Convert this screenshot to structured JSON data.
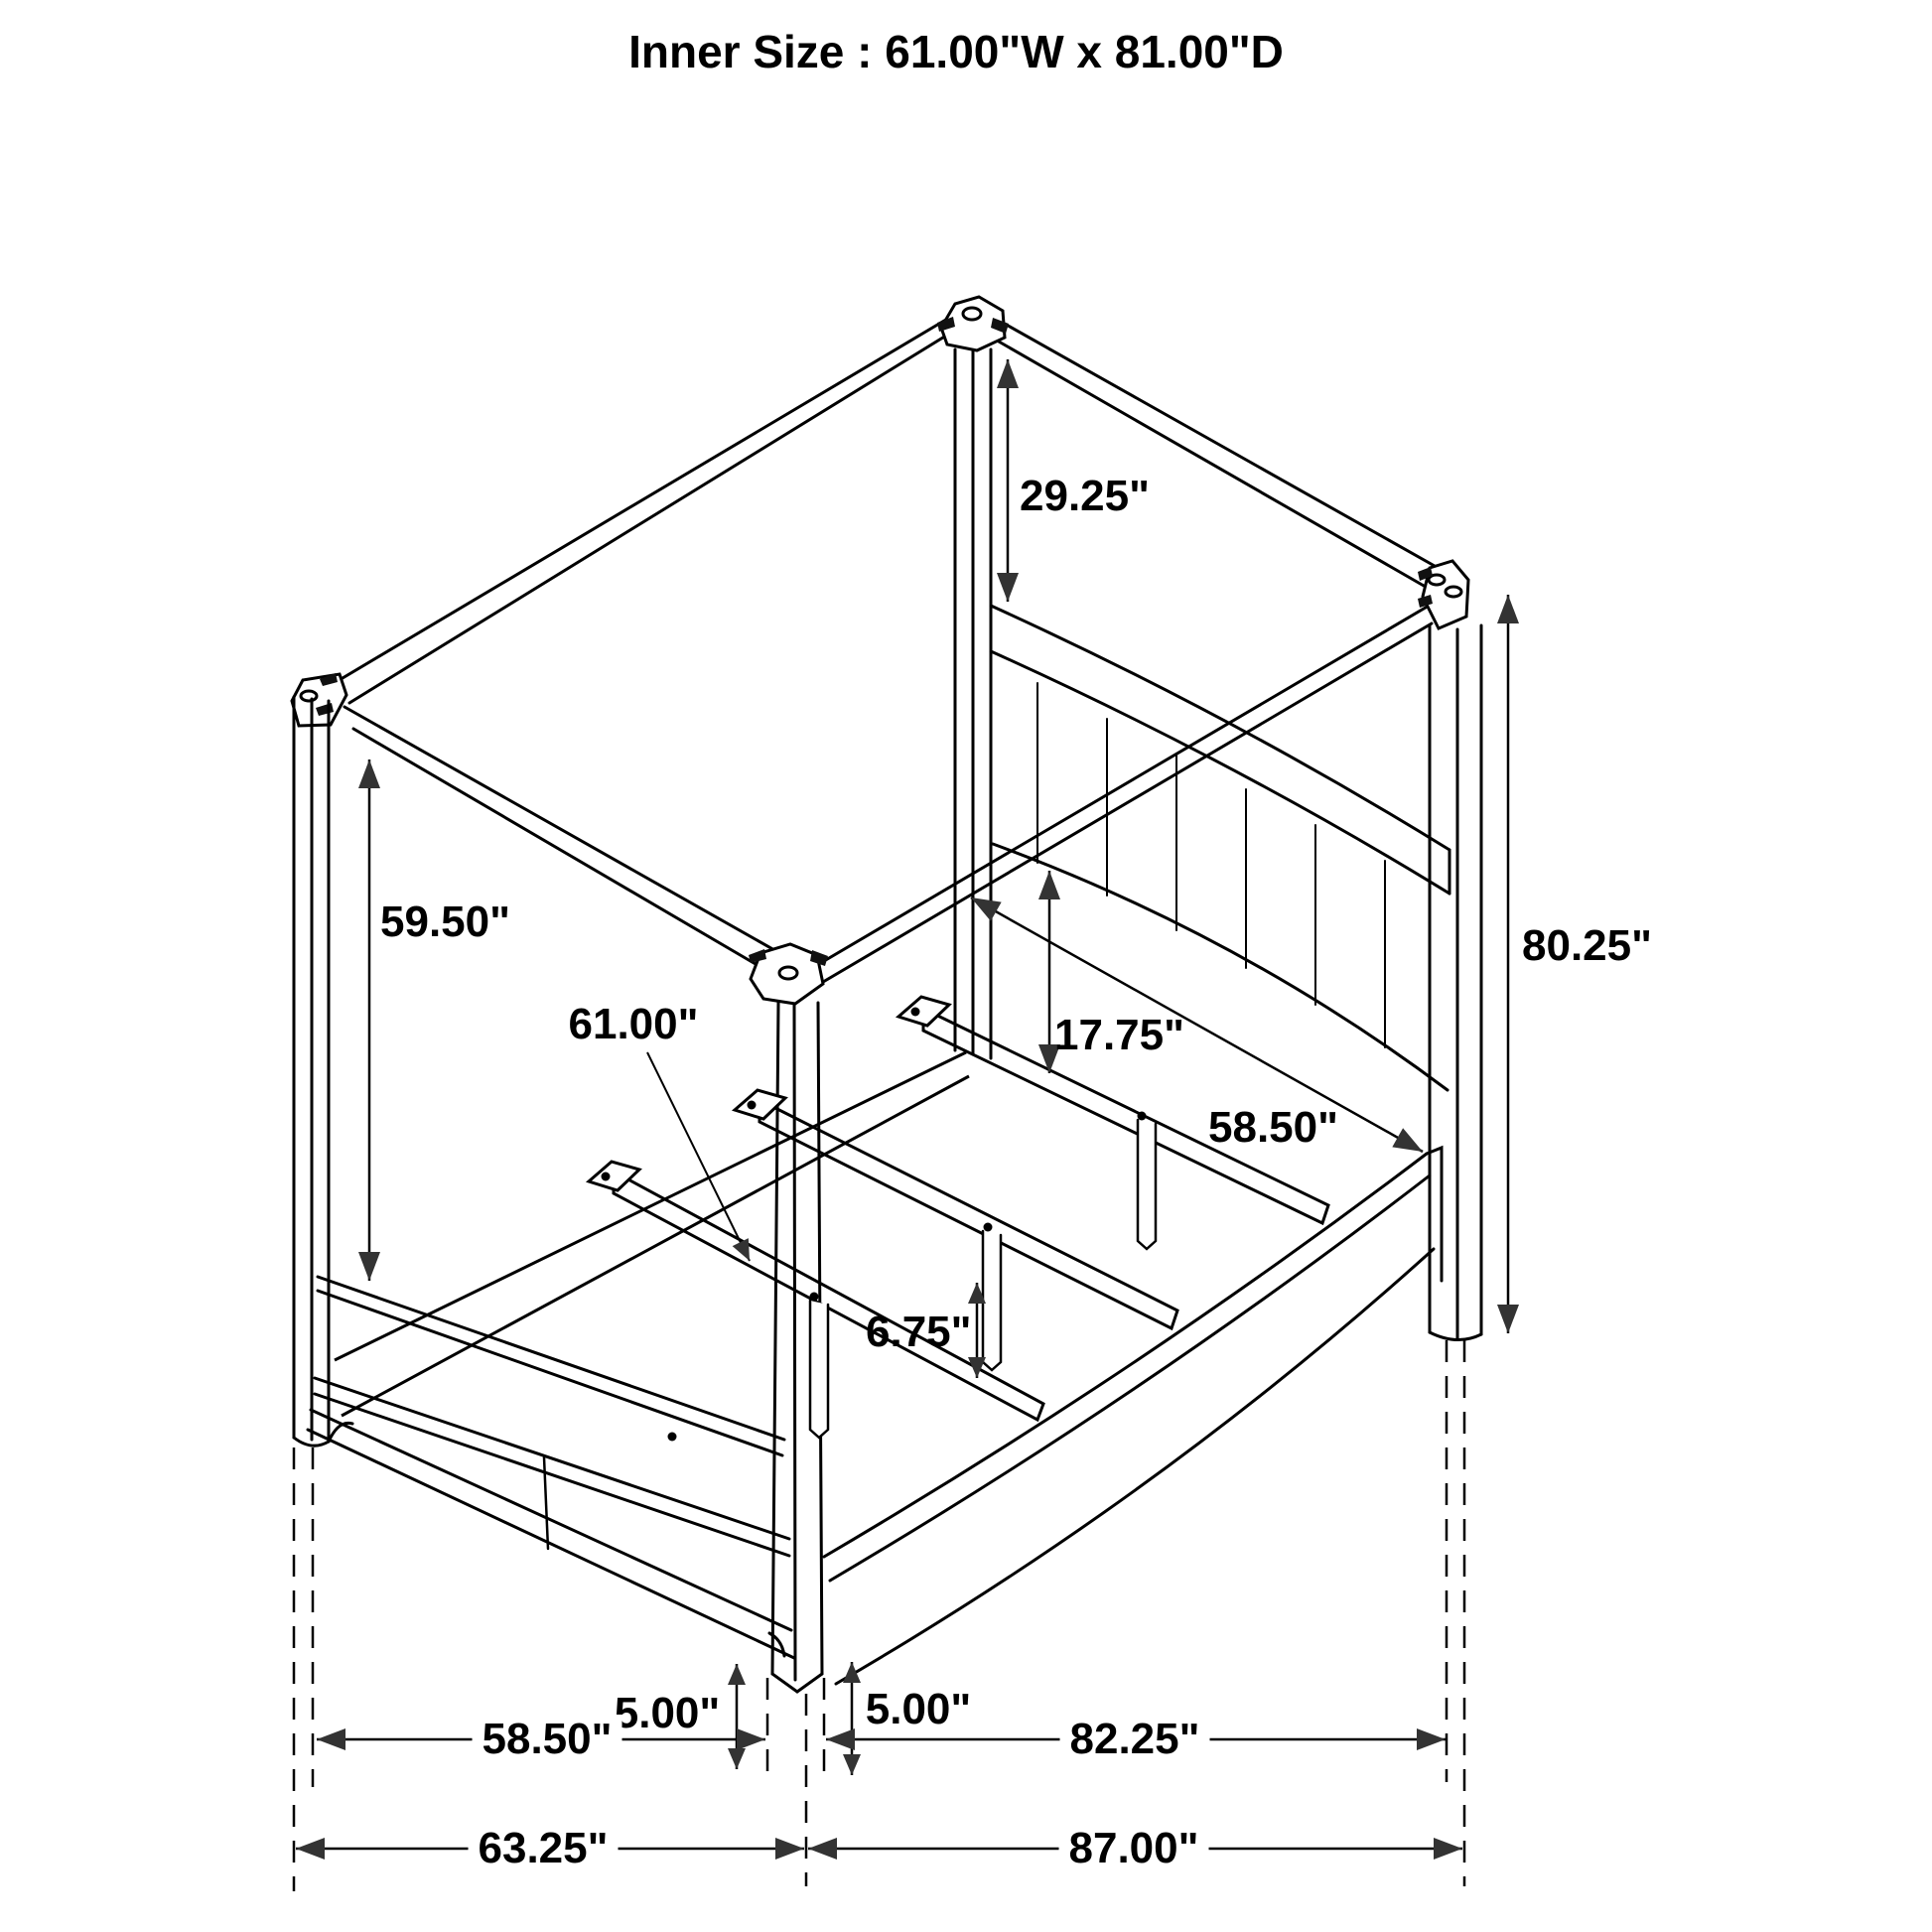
{
  "title": "Inner Size : 61.00\"W x 81.00\"D",
  "drawing": {
    "subject": "canopy bed frame",
    "style": "isometric black line drawing with dimension arrows",
    "line_color": "#000000",
    "background_color": "#ffffff"
  },
  "dimensions": {
    "dim_29_25": {
      "text": "29.25\"",
      "orientation": "vertical-arrow"
    },
    "dim_59_50": {
      "text": "59.50\"",
      "orientation": "vertical-arrow"
    },
    "dim_61_00": {
      "text": "61.00\"",
      "orientation": "leader-line"
    },
    "dim_17_75": {
      "text": "17.75\"",
      "orientation": "vertical-arrow"
    },
    "dim_58_50_mid": {
      "text": "58.50\"",
      "orientation": "diagonal-arrow"
    },
    "dim_6_75": {
      "text": "6.75\"",
      "orientation": "vertical-arrow"
    },
    "dim_80_25": {
      "text": "80.25\"",
      "orientation": "vertical-arrow"
    },
    "dim_5_00_left": {
      "text": "5.00\"",
      "orientation": "vertical-arrow"
    },
    "dim_5_00_right": {
      "text": "5.00\"",
      "orientation": "vertical-arrow"
    },
    "dim_58_50_bottom": {
      "text": "58.50\"",
      "orientation": "horizontal-arrow"
    },
    "dim_82_25": {
      "text": "82.25\"",
      "orientation": "horizontal-arrow"
    },
    "dim_63_25": {
      "text": "63.25\"",
      "orientation": "horizontal-arrow"
    },
    "dim_87_00": {
      "text": "87.00\"",
      "orientation": "horizontal-arrow"
    }
  }
}
